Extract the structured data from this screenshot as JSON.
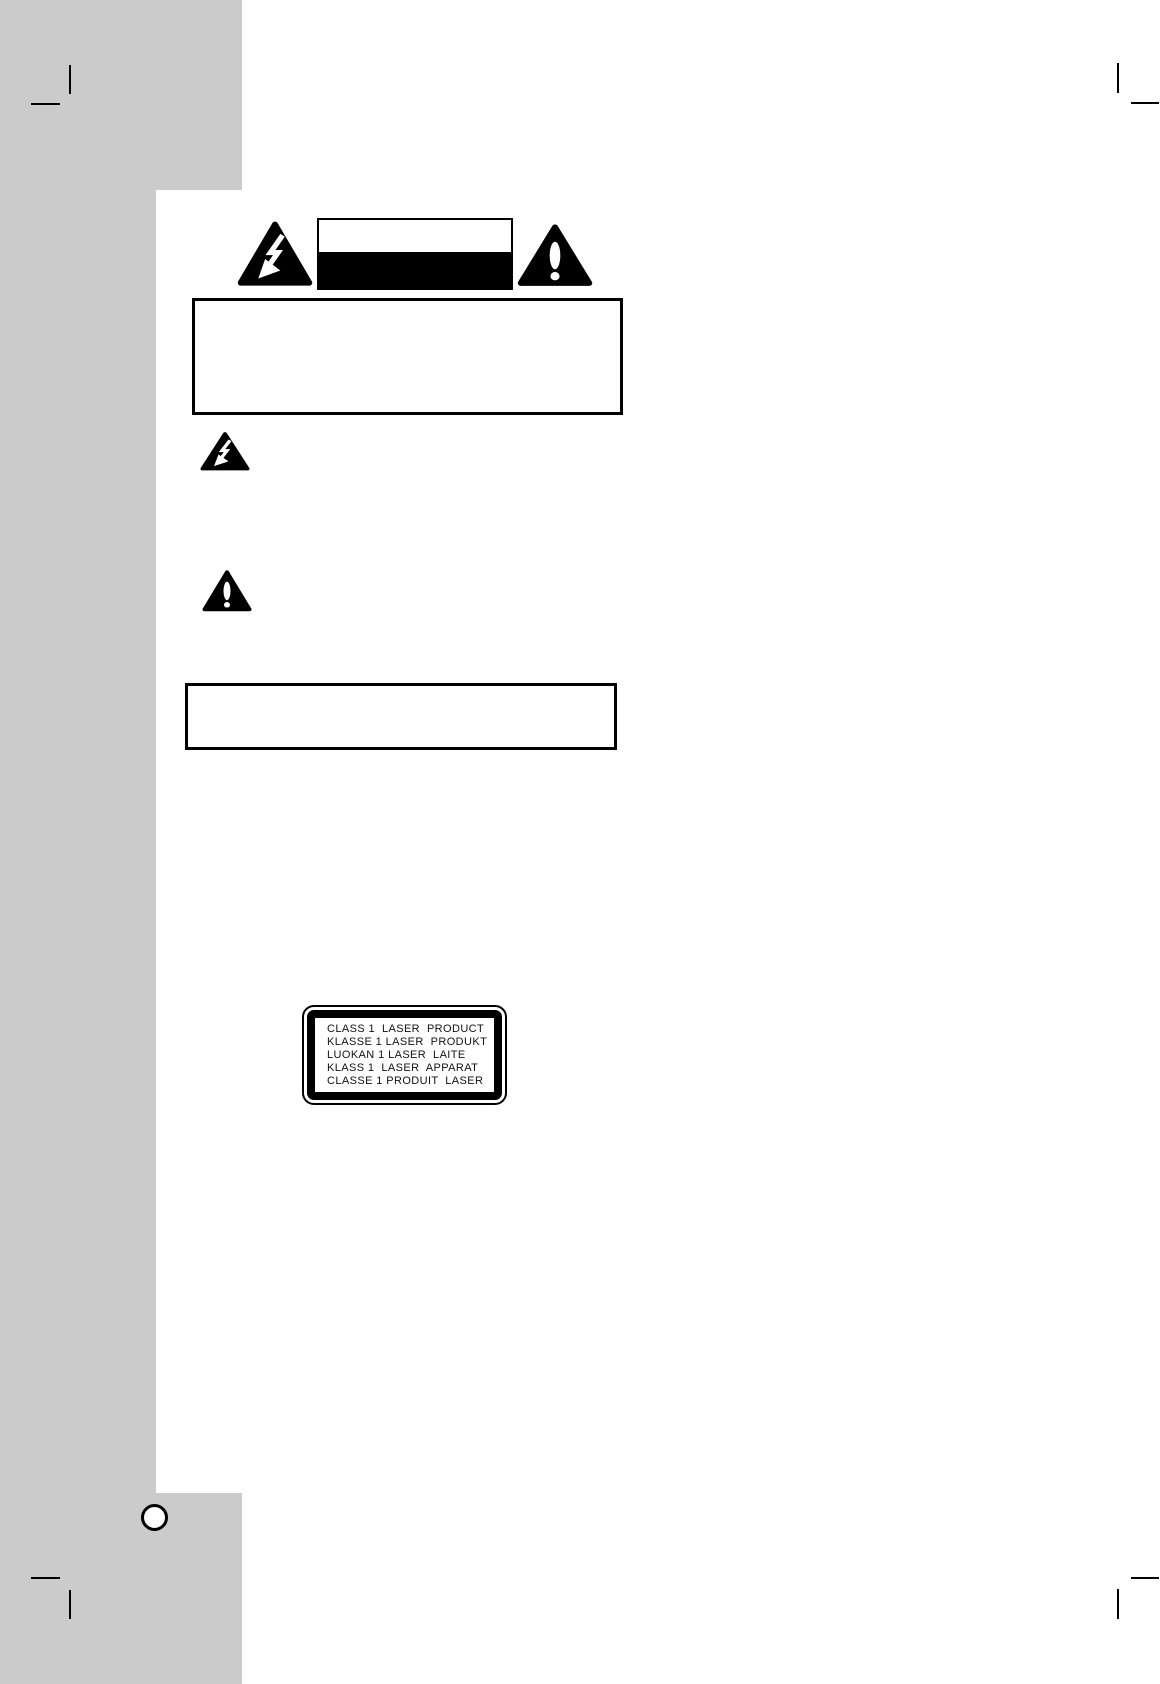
{
  "page": {
    "background_color": "#ffffff",
    "margin_color": "#cbcbcb",
    "ink_color": "#000000"
  },
  "laser_label": {
    "lines": [
      "CLASS 1  LASER  PRODUCT",
      "KLASSE 1 LASER  PRODUKT",
      "LUOKAN 1 LASER  LAITE",
      "KLASS 1  LASER  APPARAT",
      "CLASSE 1 PRODUIT  LASER"
    ]
  }
}
